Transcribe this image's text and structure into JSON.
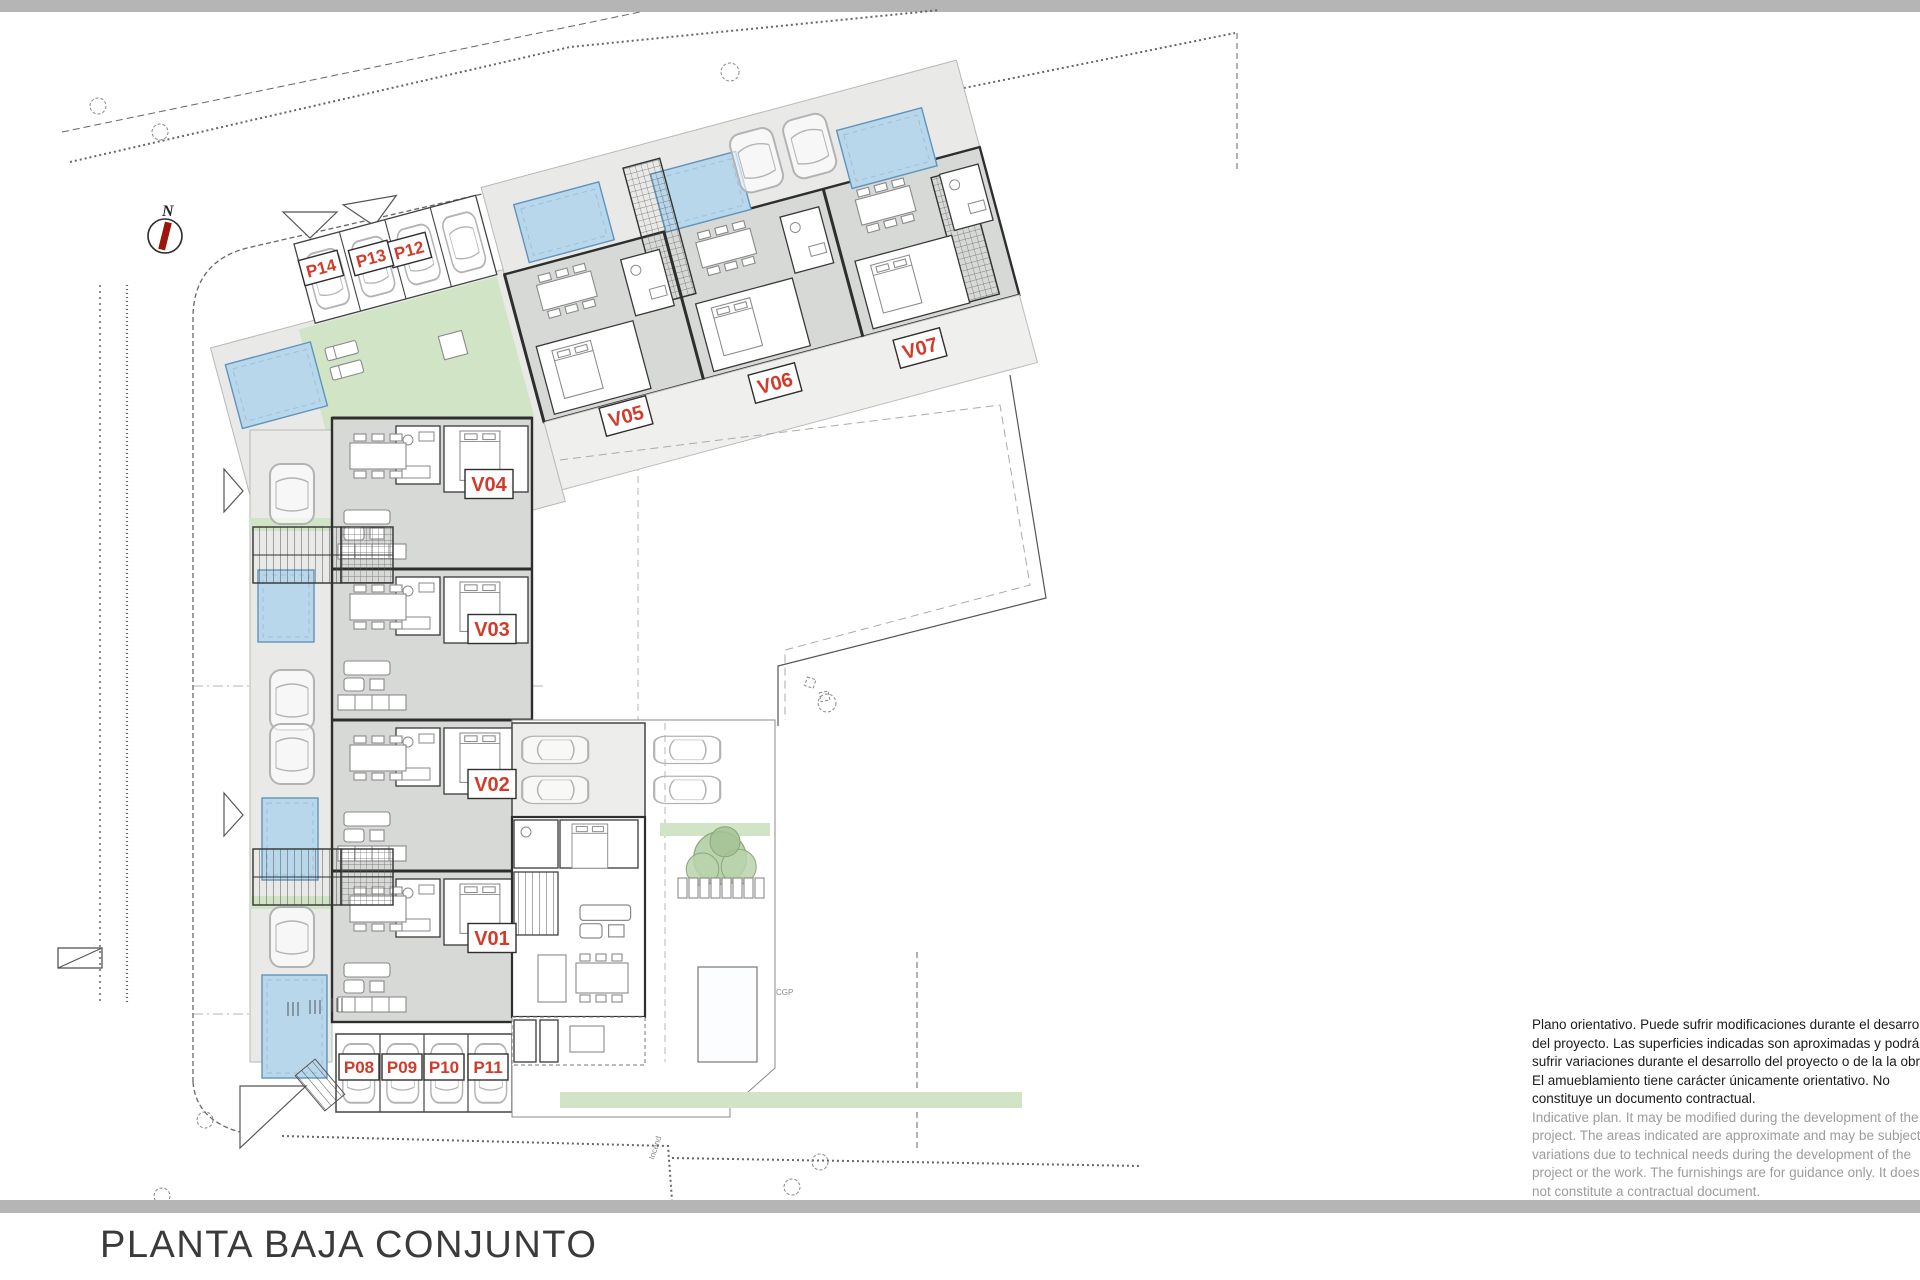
{
  "page": {
    "background": "#ffffff",
    "divider_color": "#b5b5b5"
  },
  "title": "PLANTA BAJA CONJUNTO",
  "compass": {
    "label": "N",
    "needle_color": "#9b150c"
  },
  "plan": {
    "label_color": "#d23b2a",
    "colors": {
      "building_fill": "#d7d9d6",
      "terrace_fill": "#e9eae8",
      "pool_fill": "#b9d7eb",
      "pool_edge": "#5f94bd",
      "green_fill": "#d2e4c6",
      "wall": "#2e2e2e"
    },
    "villas": [
      {
        "id": "V01"
      },
      {
        "id": "V02"
      },
      {
        "id": "V03"
      },
      {
        "id": "V04"
      },
      {
        "id": "V05"
      },
      {
        "id": "V06"
      },
      {
        "id": "V07"
      }
    ],
    "parking": [
      {
        "id": "P08"
      },
      {
        "id": "P09"
      },
      {
        "id": "P10"
      },
      {
        "id": "P11"
      },
      {
        "id": "P12"
      },
      {
        "id": "P13"
      },
      {
        "id": "P14"
      }
    ],
    "annotations": {
      "cgp": "CGP",
      "incend": "Incend"
    }
  },
  "disclaimer": {
    "es_lines": [
      "Plano orientativo. Puede sufrir modificaciones durante el desarrollo",
      "del proyecto. Las superficies indicadas son aproximadas y podrán",
      "sufrir variaciones durante el desarrollo del proyecto o de la la obra.",
      "El amueblamiento tiene carácter únicamente orientativo. No",
      "constituye un documento contractual."
    ],
    "en_lines": [
      "Indicative plan. It may be modified during the development of the",
      "project. The areas indicated are approximate and may be subject to",
      "variations due to technical needs during the development of the",
      "project or the work. The furnishings are for guidance only. It does",
      "not constitute a contractual document."
    ]
  }
}
